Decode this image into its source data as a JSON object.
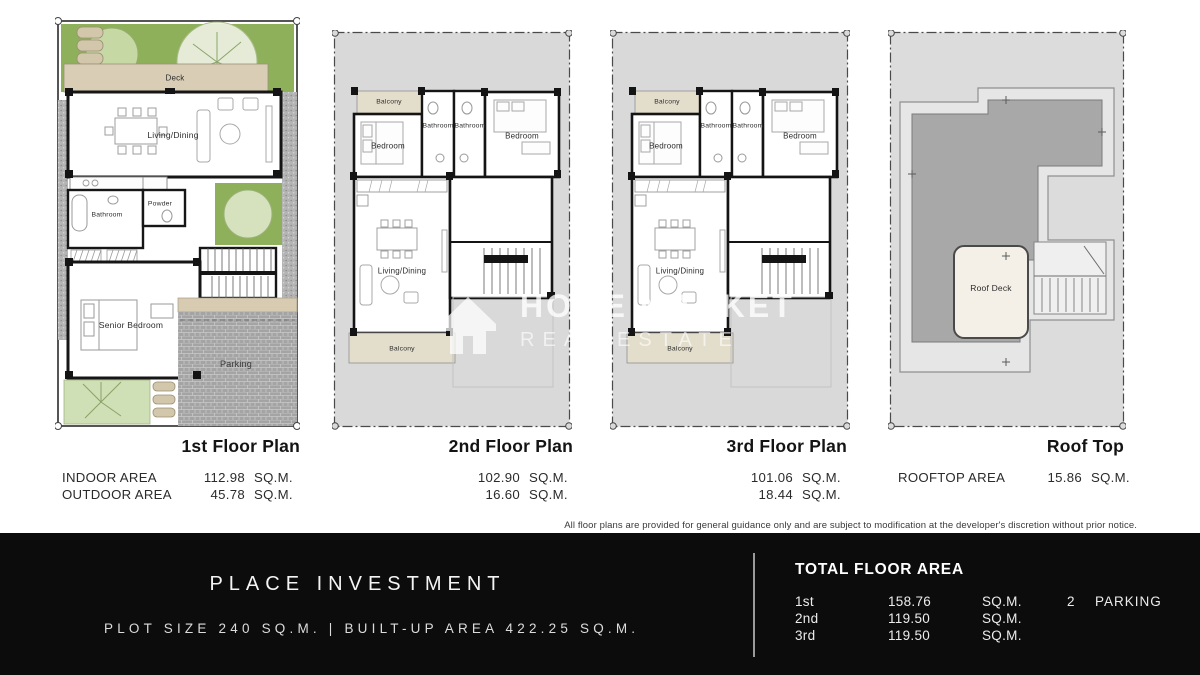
{
  "plans": [
    {
      "title": "1st Floor Plan",
      "areas": [
        {
          "label": "INDOOR  AREA",
          "value": "112.98",
          "unit": "SQ.M."
        },
        {
          "label": "OUTDOOR AREA",
          "value": "45.78",
          "unit": "SQ.M."
        }
      ],
      "rooms": {
        "deck": "Deck",
        "living": "Living/Dining",
        "powder": "Powder",
        "bathroom": "Bathroom",
        "senior_bedroom": "Senior Bedroom",
        "parking": "Parking"
      }
    },
    {
      "title": "2nd Floor Plan",
      "areas": [
        {
          "label": "",
          "value": "102.90",
          "unit": "SQ.M."
        },
        {
          "label": "",
          "value": "16.60",
          "unit": "SQ.M."
        }
      ],
      "rooms": {
        "balcony_top": "Balcony",
        "bedroom_left": "Bedroom",
        "bathroom_left": "Bathroom",
        "bathroom_right": "Bathroom",
        "bedroom_right": "Bedroom",
        "living": "Living/Dining",
        "balcony_bottom": "Balcony"
      }
    },
    {
      "title": "3rd Floor Plan",
      "areas": [
        {
          "label": "",
          "value": "101.06",
          "unit": "SQ.M."
        },
        {
          "label": "",
          "value": "18.44",
          "unit": "SQ.M."
        }
      ],
      "rooms": {
        "balcony_top": "Balcony",
        "bedroom_left": "Bedroom",
        "bathroom_left": "Bathroom",
        "bathroom_right": "Bathroom",
        "bedroom_right": "Bedroom",
        "living": "Living/Dining",
        "balcony_bottom": "Balcony"
      }
    },
    {
      "title": "Roof Top",
      "areas": [
        {
          "label": "ROOFTOP AREA",
          "value": "15.86",
          "unit": "SQ.M."
        }
      ],
      "rooms": {
        "roof_deck": "Roof Deck"
      }
    }
  ],
  "disclaimer": "All floor plans are provided for general guidance only and are subject to modification at the developer's discretion without prior notice.",
  "watermark": {
    "line1": "HOME MARKET",
    "line2": "REAL ESTATE"
  },
  "footer": {
    "brand": "PLACE INVESTMENT",
    "plot_info": "PLOT SIZE 240 SQ.M. | BUILT-UP AREA 422.25 SQ.M.",
    "total_title": "TOTAL FLOOR AREA",
    "rows": [
      {
        "floor": "1st",
        "value": "158.76",
        "unit": "SQ.M.",
        "count": "2",
        "count_label": "PARKING"
      },
      {
        "floor": "2nd",
        "value": "119.50",
        "unit": "SQ.M.",
        "count": "",
        "count_label": ""
      },
      {
        "floor": "3rd",
        "value": "119.50",
        "unit": "SQ.M.",
        "count": "",
        "count_label": ""
      }
    ]
  },
  "colors": {
    "lawn_green": "#8fb05a",
    "deck_beige": "#d9cdb5",
    "plot_gray": "#d9d9d9",
    "roof_gray": "#a8a8a8",
    "footer_bg": "#0c0c0c"
  }
}
